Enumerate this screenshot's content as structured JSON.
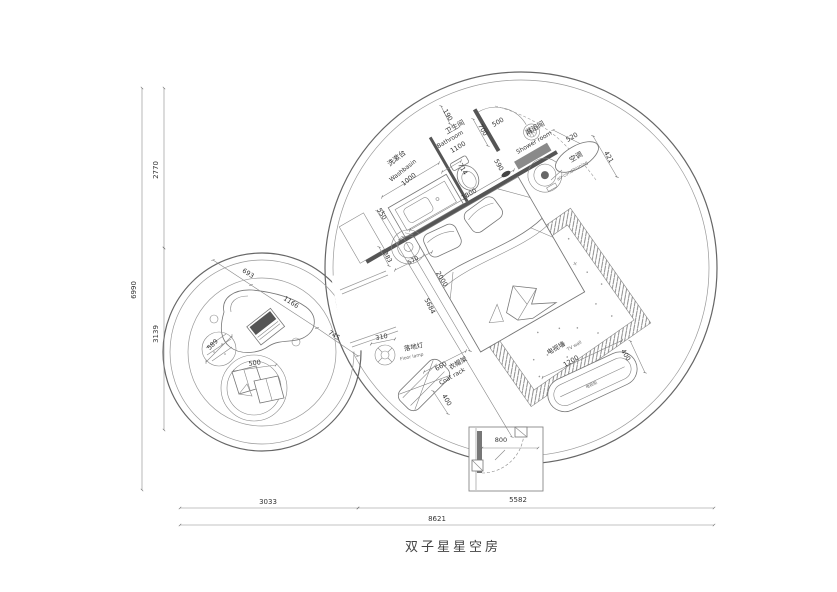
{
  "title": "双子星星空房",
  "labels": {
    "washbasin": {
      "zh": "洗漱台",
      "en": "Washbasin"
    },
    "bathroom": {
      "zh": "卫生间",
      "en": "Bathroom"
    },
    "shower": {
      "zh": "淋浴间",
      "en": "Shower room"
    },
    "ac": {
      "zh": "空调",
      "en": "air-conditioning"
    },
    "floor_lamp": {
      "zh": "落地灯",
      "en": "Floor lamp"
    },
    "coat_rack": {
      "zh": "衣帽架",
      "en": "Coat rack"
    },
    "tv_wall": {
      "zh": "电视墙",
      "en": "TV wall"
    },
    "tv_cabinet": {
      "zh": "电视柜"
    }
  },
  "dims": {
    "left_total": "6990",
    "left_seg1": "2770",
    "left_seg2": "3139",
    "bottom_seg1": "3033",
    "bottom_seg2": "5582",
    "bottom_total": "8621",
    "lounge_seg1": "693",
    "lounge_seg2": "1166",
    "lounge_seg3": "745",
    "lounge_circle": "589",
    "lounge_seat": "500",
    "wall_190": "190",
    "door_700": "700",
    "door_500": "500",
    "niche_590": "590",
    "bench_520": "520",
    "ac_421": "421",
    "toilet_714": "714",
    "bed_width": "1800",
    "bed_length": "2000",
    "vanity_550": "550",
    "washbasin_1000": "1000",
    "bathroom_1100": "1100",
    "ac_383": "383",
    "ac_570": "570",
    "diag_5684": "5684",
    "lamp_310": "310",
    "coat_660": "660",
    "coat_400": "400",
    "tv_1200": "1200",
    "tv_400": "400",
    "entry_800": "800"
  }
}
